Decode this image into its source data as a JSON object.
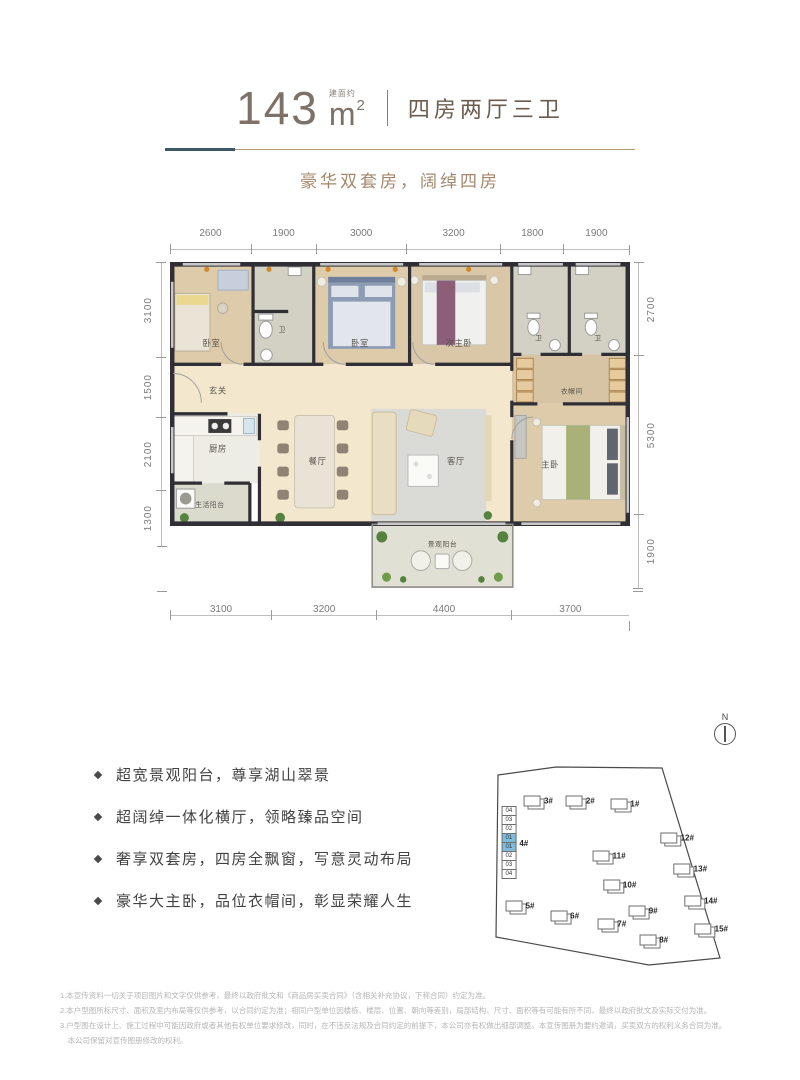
{
  "header": {
    "area_value": "143",
    "area_note": "建面约",
    "unit_base": "m",
    "unit_sup": "2",
    "layout_text": "四房两厅三卫",
    "subtitle": "豪华双套房，阔绰四房",
    "colors": {
      "teal": "#3d5a64",
      "tan": "#b59b75",
      "highlight_blue": "#7fbbdc"
    }
  },
  "floorplan": {
    "dims_top": [
      "2600",
      "1900",
      "3000",
      "3200",
      "1800",
      "1900"
    ],
    "dims_bottom": [
      "3100",
      "3200",
      "4400",
      "3700"
    ],
    "dims_left": [
      "3100",
      "1500",
      "2100",
      "1300"
    ],
    "dims_right": [
      "2700",
      "5300",
      "1900"
    ],
    "rooms": {
      "bedroom_left": "卧室",
      "bath_small": "卫",
      "bedroom_mid": "卧室",
      "junior_master": "次主卧",
      "bath_right1": "卫",
      "bath_right2": "卫",
      "closet": "衣帽间",
      "foyer": "玄关",
      "kitchen": "厨房",
      "service_balcony": "生活阳台",
      "dining": "餐厅",
      "living": "客厅",
      "master": "主卧",
      "view_balcony": "景观阳台"
    }
  },
  "features": {
    "items": [
      "超宽景观阳台，尊享湖山翠景",
      "超阔绰一体化横厅，领略臻品空间",
      "奢享双套房，四房全飘窗，写意灵动布局",
      "豪华大主卧，品位衣帽间，彰显荣耀人生"
    ]
  },
  "siteplan": {
    "north_label": "N",
    "buildings": [
      {
        "label": "3#",
        "x": 20,
        "y": 34
      },
      {
        "label": "2#",
        "x": 36,
        "y": 34
      },
      {
        "label": "1#",
        "x": 53,
        "y": 35
      },
      {
        "label": "4#",
        "x": 11,
        "y": 50,
        "cells": [
          "04",
          "03",
          "02",
          "01",
          "01",
          "02",
          "03",
          "04"
        ],
        "hl_idx": [
          3,
          4
        ]
      },
      {
        "label": "11#",
        "x": 47,
        "y": 55
      },
      {
        "label": "12#",
        "x": 73,
        "y": 48
      },
      {
        "label": "10#",
        "x": 51,
        "y": 66
      },
      {
        "label": "13#",
        "x": 78,
        "y": 60
      },
      {
        "label": "9#",
        "x": 60,
        "y": 76
      },
      {
        "label": "14#",
        "x": 82,
        "y": 72
      },
      {
        "label": "5#",
        "x": 13,
        "y": 74
      },
      {
        "label": "6#",
        "x": 30,
        "y": 78
      },
      {
        "label": "7#",
        "x": 48,
        "y": 81
      },
      {
        "label": "8#",
        "x": 64,
        "y": 87
      },
      {
        "label": "15#",
        "x": 86,
        "y": 83
      }
    ]
  },
  "footer": {
    "lines": [
      "1.本宣传资料一切关于项目图片和文字仅供参考，最终以政府批文和《商品房买卖合同》（含相关补充协议，下称合同）约定为准。",
      "2.本户型图所标尺寸、面积及室内布局等仅供参考，以合同约定为准；相同户型单位因楼栋、楼层、位置、朝向等差别，局部结构、尺寸、面积等有可能有所不同，最终以政府批文及实际交付为准。",
      "3.户型图在设计上、施工过程中可能因政府或者其他有权单位要求修改，同时，在不违反法规及合同约定的前提下，本公司亦有权做出细部调整。本宣传图册为要约邀请，买卖双方的权利义务合同为准。",
      "　本公司保留对宣传图册修改的权利。"
    ]
  }
}
